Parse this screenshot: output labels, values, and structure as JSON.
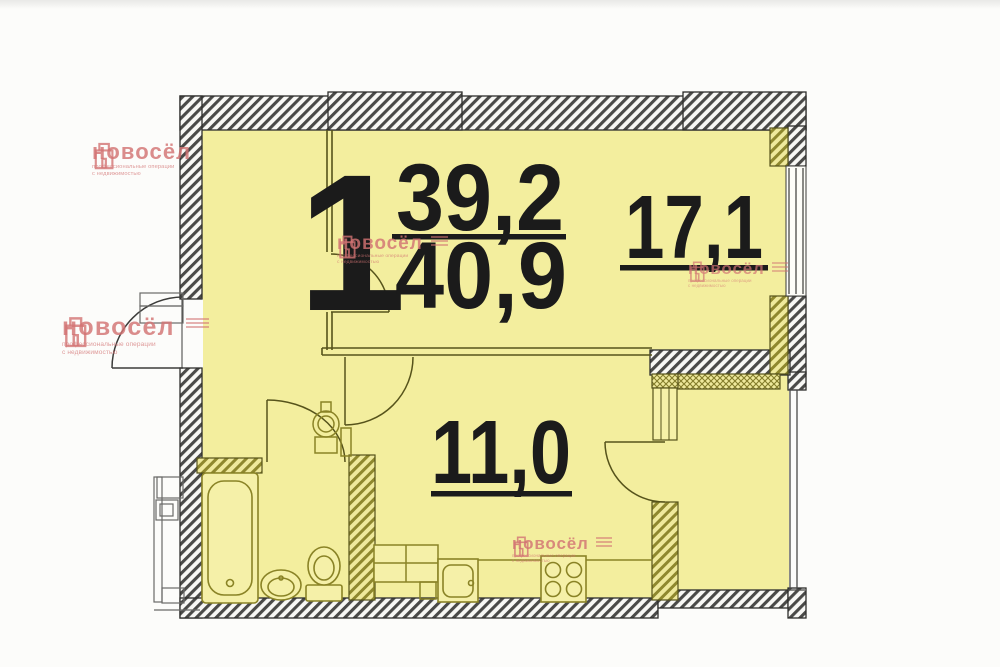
{
  "plan": {
    "rooms_count": "1",
    "area_top": "39,2",
    "area_bottom": "40,9",
    "living_room_area": "17,1",
    "kitchen_area": "11,0"
  },
  "watermark": {
    "brand": "новосёл",
    "tagline1": "профессиональные операции",
    "tagline2": "с недвижимостью"
  },
  "colors": {
    "room_fill": "#f3ee9e",
    "wall_hatch_dark": "#4a4a48",
    "wall_hatch_olive": "#8f882e",
    "fixture_stroke": "#8a8326",
    "label_color": "#1b1b1b",
    "watermark_pink": "#d27373"
  }
}
